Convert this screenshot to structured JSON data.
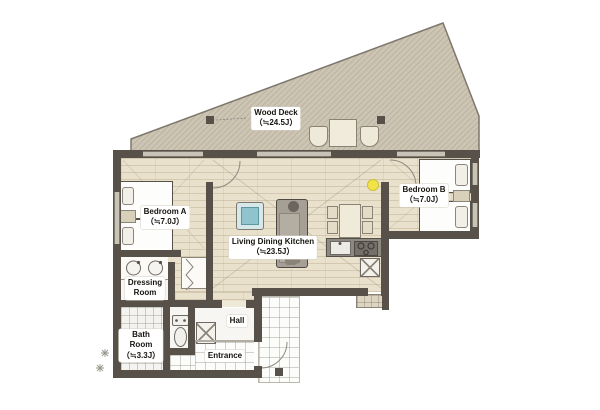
{
  "floor_plan": {
    "rooms": {
      "wood_deck": {
        "name": "Wood Deck",
        "size": "（≒24.5J）"
      },
      "bedroom_a": {
        "name": "Bedroom A",
        "size": "（≒7.0J）"
      },
      "bedroom_b": {
        "name": "Bedroom B",
        "size": "（≒7.0J）"
      },
      "living_dining_kitchen": {
        "name": "Living Dining Kitchen",
        "size": "（≒23.5J）"
      },
      "dressing_room": {
        "name_line1": "Dressing",
        "name_line2": "Room"
      },
      "bath_room": {
        "name_line1": "Bath",
        "name_line2": "Room",
        "size": "（≒3.3J）"
      },
      "hall": {
        "name": "Hall"
      },
      "entrance": {
        "name": "Entrance"
      }
    },
    "colors": {
      "wall": "#57514a",
      "wood_floor": "#e9e1cb",
      "deck": "#cdc5b4",
      "deck_hatch": "#b2a995",
      "accent_table": "#8fc3cd",
      "light_fixture": "#f3e34b",
      "tile_floor": "#f4f3ef"
    }
  }
}
